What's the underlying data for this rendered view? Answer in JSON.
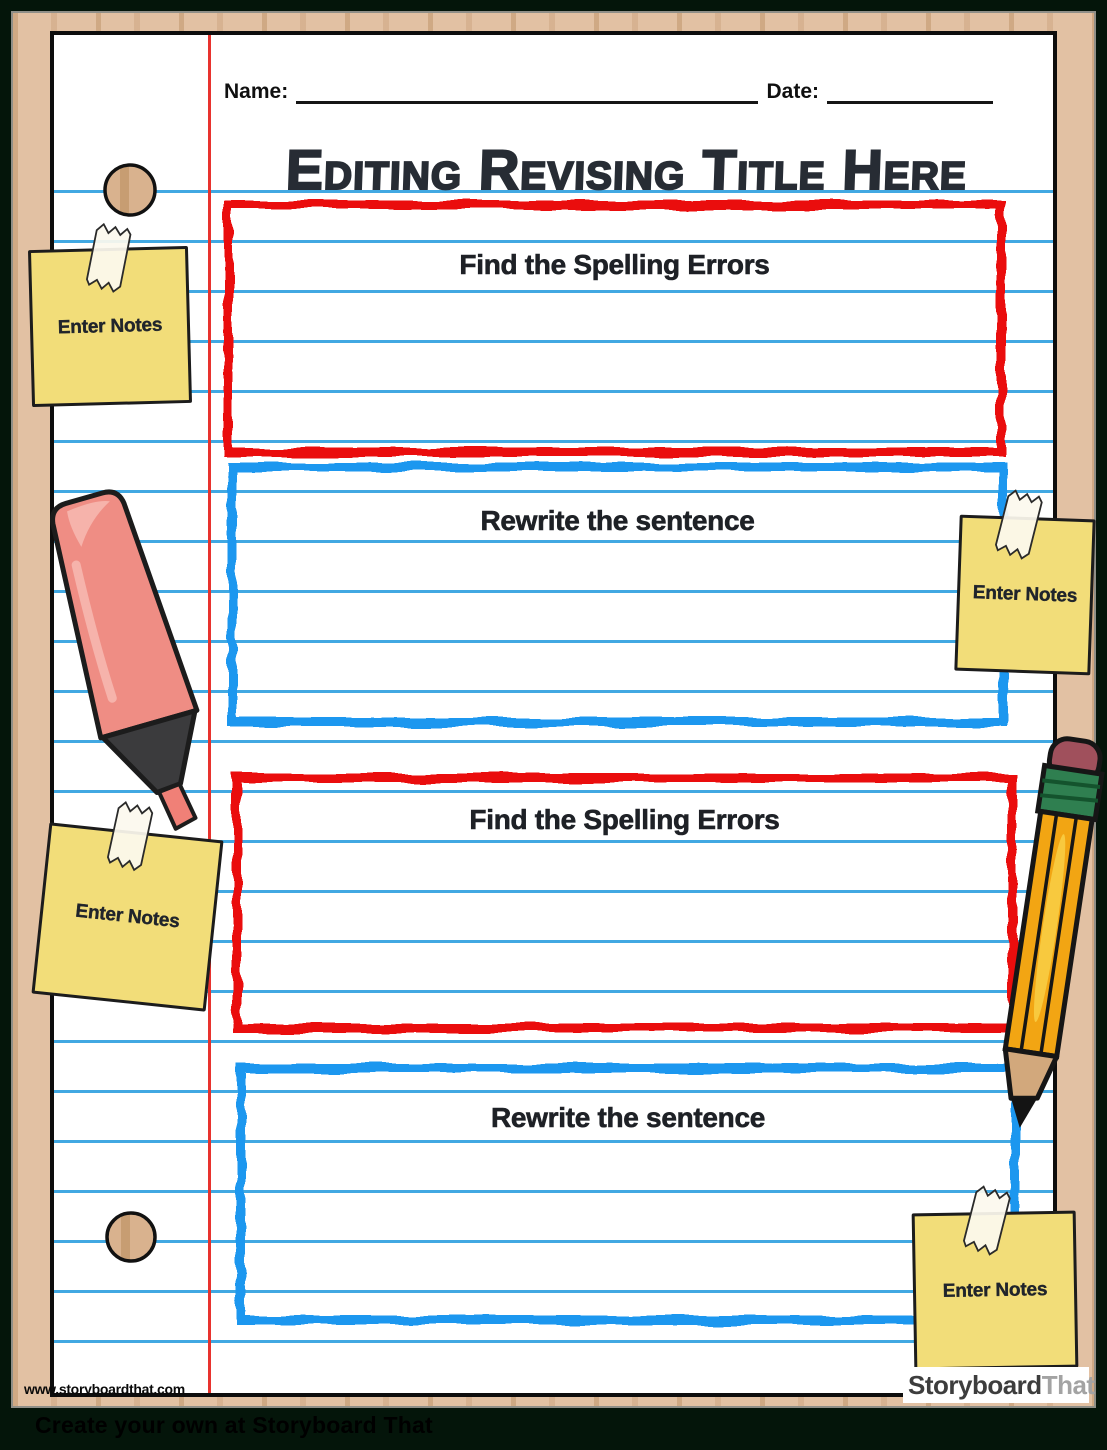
{
  "header": {
    "name_label": "Name:",
    "date_label": "Date:"
  },
  "title": "Editing Revising Title Here",
  "sections": [
    {
      "label": "Find the Spelling Errors",
      "border_color": "#ea1111"
    },
    {
      "label": "Rewrite the sentence",
      "border_color": "#1e97ef"
    },
    {
      "label": "Find the Spelling Errors",
      "border_color": "#ea1111"
    },
    {
      "label": "Rewrite the sentence",
      "border_color": "#1e97ef"
    }
  ],
  "sticky_notes": [
    {
      "text": "Enter Notes"
    },
    {
      "text": "Enter Notes"
    },
    {
      "text": "Enter Notes"
    },
    {
      "text": "Enter Notes"
    }
  ],
  "footer": {
    "site_url": "www.storyboardthat.com",
    "logo_storyboard": "Storyboard",
    "logo_that": "That",
    "caption": "Create your own at Storyboard That"
  },
  "colors": {
    "sketch_red": "#ea1111",
    "sketch_blue": "#1e97ef",
    "ruled_line": "#41a8e2",
    "margin_line": "#e8332e",
    "sticky_note_fill": "#f2dd79",
    "paper": "#ffffff",
    "wood": "#e2c1a3",
    "background_green": "#04150a",
    "highlighter_body": "#ef8d84",
    "pencil_body": "#f2a513"
  }
}
